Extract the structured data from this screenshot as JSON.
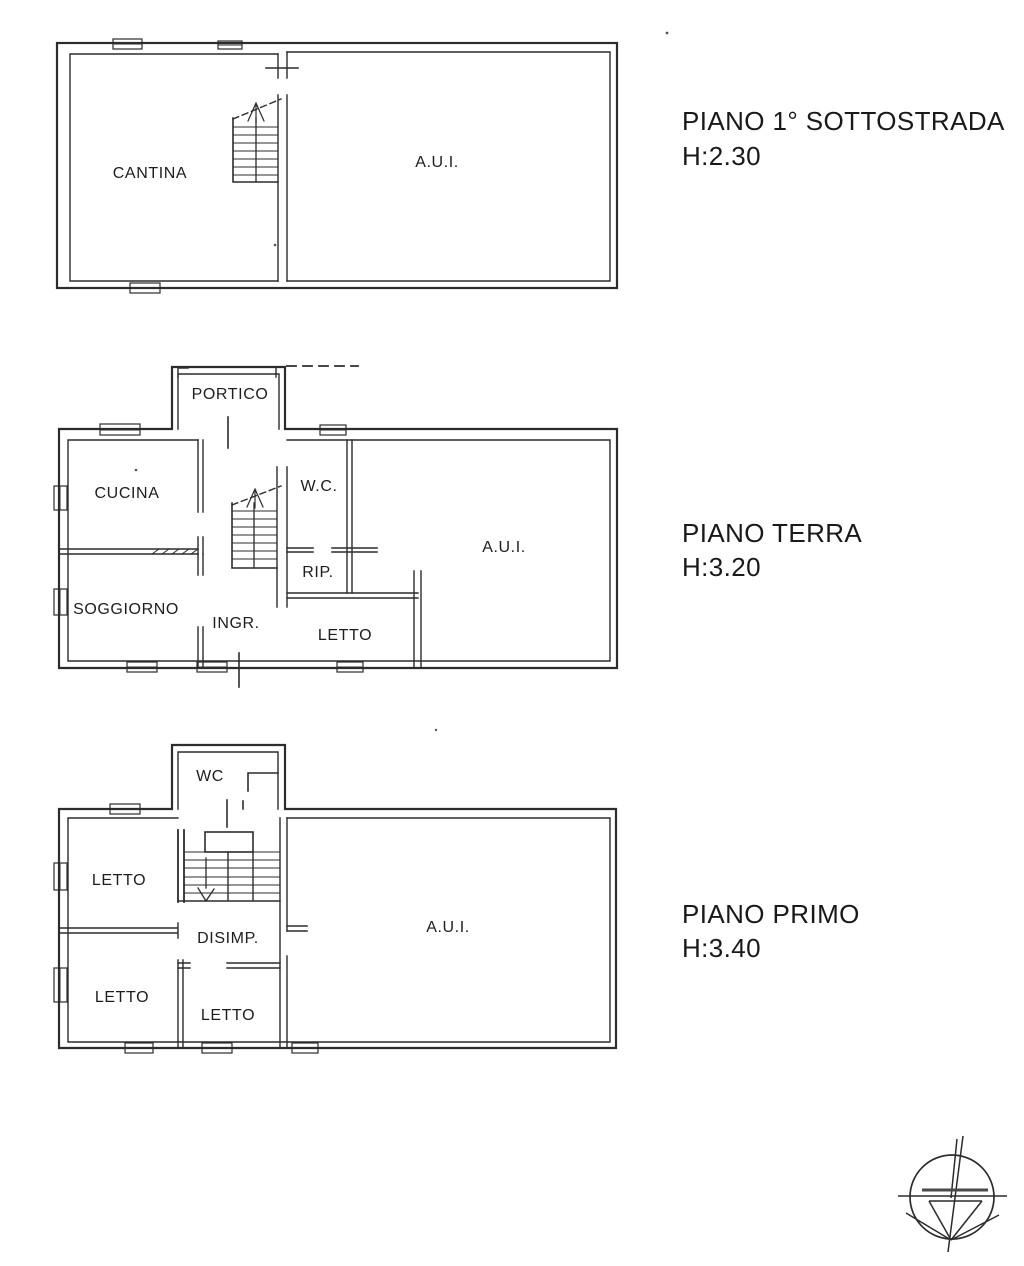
{
  "page": {
    "background": "#ffffff",
    "ink_color": "#2c2c2c"
  },
  "floors": [
    {
      "id": "sottostrada",
      "title": "PIANO 1° SOTTOSTRADA",
      "height_label": "H:2.30",
      "rooms": [
        {
          "label": "CANTINA"
        },
        {
          "label": "A.U.I."
        }
      ]
    },
    {
      "id": "terra",
      "title": "PIANO TERRA",
      "height_label": "H:3.20",
      "rooms": [
        {
          "label": "PORTICO"
        },
        {
          "label": "CUCINA"
        },
        {
          "label": "W.C."
        },
        {
          "label": "SOGGIORNO"
        },
        {
          "label": "RIP."
        },
        {
          "label": "INGR."
        },
        {
          "label": "LETTO"
        },
        {
          "label": "A.U.I."
        }
      ]
    },
    {
      "id": "primo",
      "title": "PIANO PRIMO",
      "height_label": "H:3.40",
      "rooms": [
        {
          "label": "WC"
        },
        {
          "label": "LETTO"
        },
        {
          "label": "DISIMP."
        },
        {
          "label": "LETTO"
        },
        {
          "label": "LETTO"
        },
        {
          "label": "A.U.I."
        }
      ]
    }
  ],
  "icons": {
    "compass": "compass-rose-icon"
  }
}
